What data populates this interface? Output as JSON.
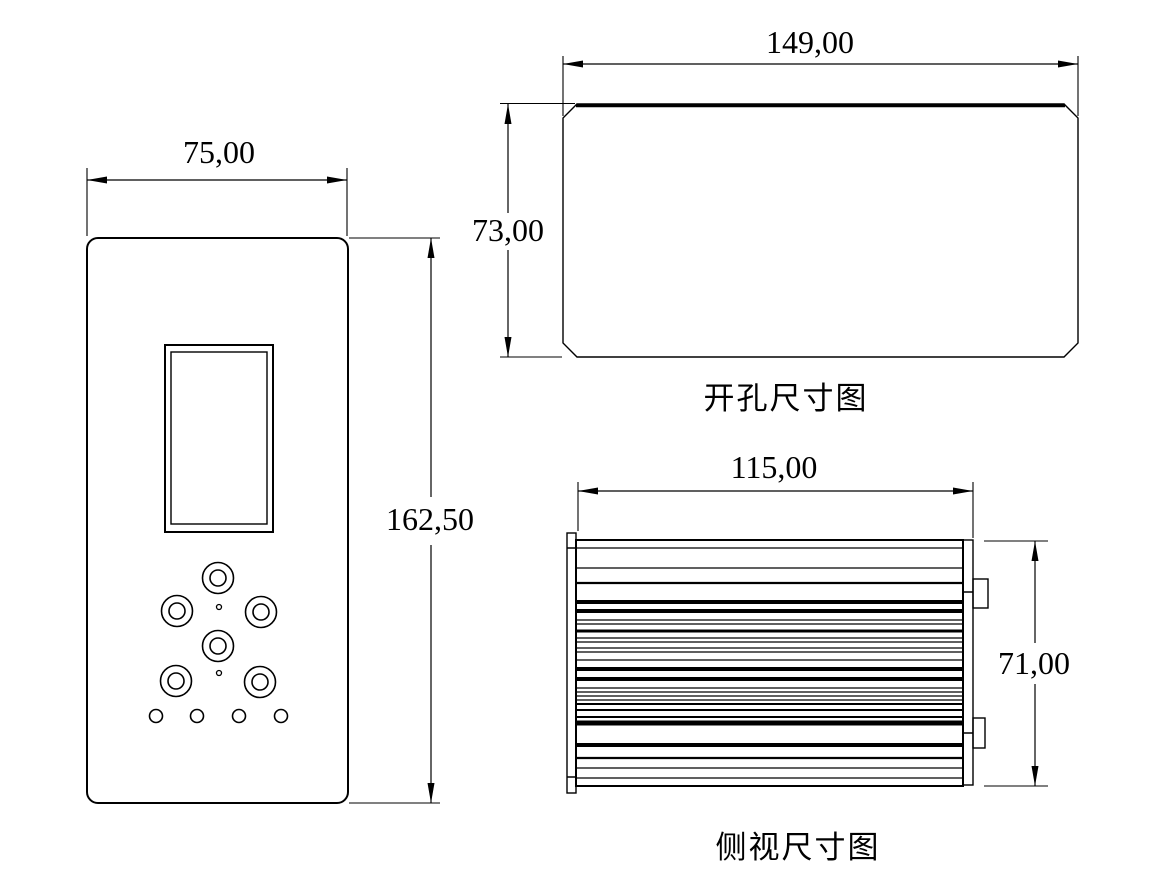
{
  "page": {
    "background": "#ffffff",
    "line_color": "#000000"
  },
  "front_view": {
    "width_dim": "75,00",
    "height_dim": "162,50",
    "buttons": {
      "outer_r": 15.5,
      "inner_r": 8,
      "positions": [
        {
          "cx": 218,
          "cy": 578
        },
        {
          "cx": 177,
          "cy": 611
        },
        {
          "cx": 261,
          "cy": 612
        },
        {
          "cx": 218,
          "cy": 646
        },
        {
          "cx": 176,
          "cy": 681
        },
        {
          "cx": 260,
          "cy": 682
        }
      ]
    },
    "dots": {
      "r": 2.5,
      "positions": [
        {
          "cx": 219,
          "cy": 607
        },
        {
          "cx": 219,
          "cy": 673
        }
      ]
    },
    "leds": {
      "r": 6.5,
      "positions": [
        {
          "cx": 156,
          "cy": 716
        },
        {
          "cx": 197,
          "cy": 716
        },
        {
          "cx": 239,
          "cy": 716
        },
        {
          "cx": 281,
          "cy": 716
        }
      ]
    }
  },
  "cutout_view": {
    "title": "开孔尺寸图",
    "width_dim": "149,00",
    "height_dim": "73,00"
  },
  "side_view": {
    "title": "侧视尺寸图",
    "width_dim": "115,00",
    "height_dim": "71,00",
    "fins": [
      {
        "y": 548,
        "w": 1.2
      },
      {
        "y": 568,
        "w": 1.2
      },
      {
        "y": 583,
        "w": 2.2
      },
      {
        "y": 602,
        "w": 4
      },
      {
        "y": 611,
        "w": 4
      },
      {
        "y": 620,
        "w": 1.2
      },
      {
        "y": 624,
        "w": 1.2
      },
      {
        "y": 631,
        "w": 3
      },
      {
        "y": 638,
        "w": 1.2
      },
      {
        "y": 642,
        "w": 1.2
      },
      {
        "y": 648,
        "w": 1.2
      },
      {
        "y": 652,
        "w": 1.2
      },
      {
        "y": 660,
        "w": 1.2
      },
      {
        "y": 669,
        "w": 4
      },
      {
        "y": 679,
        "w": 4
      },
      {
        "y": 688,
        "w": 1.2
      },
      {
        "y": 692,
        "w": 1.2
      },
      {
        "y": 696,
        "w": 1.2
      },
      {
        "y": 700,
        "w": 1.2
      },
      {
        "y": 704,
        "w": 2
      },
      {
        "y": 710,
        "w": 2
      },
      {
        "y": 717,
        "w": 2
      },
      {
        "y": 723,
        "w": 5
      },
      {
        "y": 745,
        "w": 4
      },
      {
        "y": 758,
        "w": 2.2
      },
      {
        "y": 768,
        "w": 1.2
      },
      {
        "y": 778,
        "w": 1.2
      }
    ]
  }
}
